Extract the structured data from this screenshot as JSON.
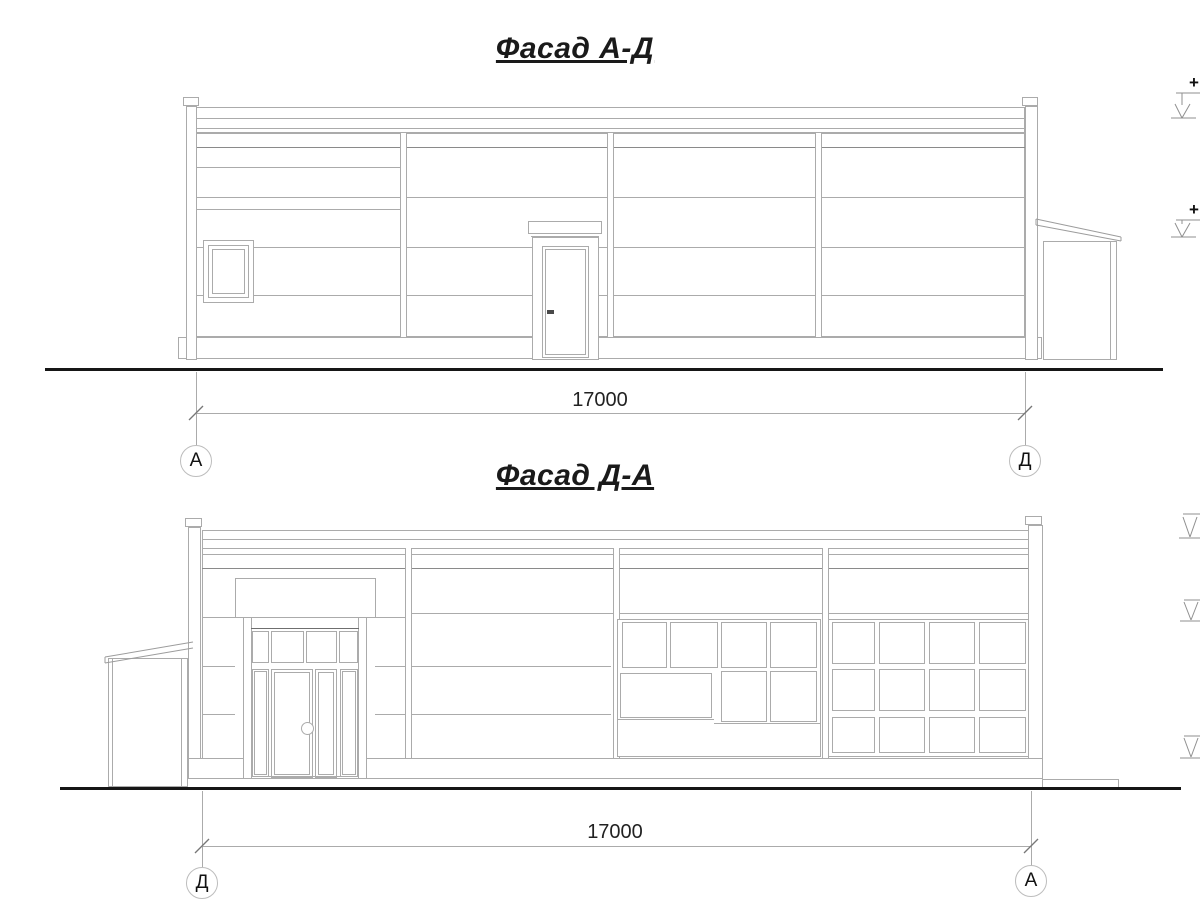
{
  "colors": {
    "background": "#ffffff",
    "thin_line": "#ababab",
    "dark_line": "#6f6f6f",
    "ground_line": "#161616",
    "text": "#1a1a1a"
  },
  "facade_top": {
    "title": "Фасад А-Д",
    "dimension": "17000",
    "axis_left": "А",
    "axis_right": "Д",
    "elevation_plus": "+"
  },
  "facade_bottom": {
    "title": "Фасад Д-А",
    "dimension": "17000",
    "axis_left": "Д",
    "axis_right": "А"
  }
}
